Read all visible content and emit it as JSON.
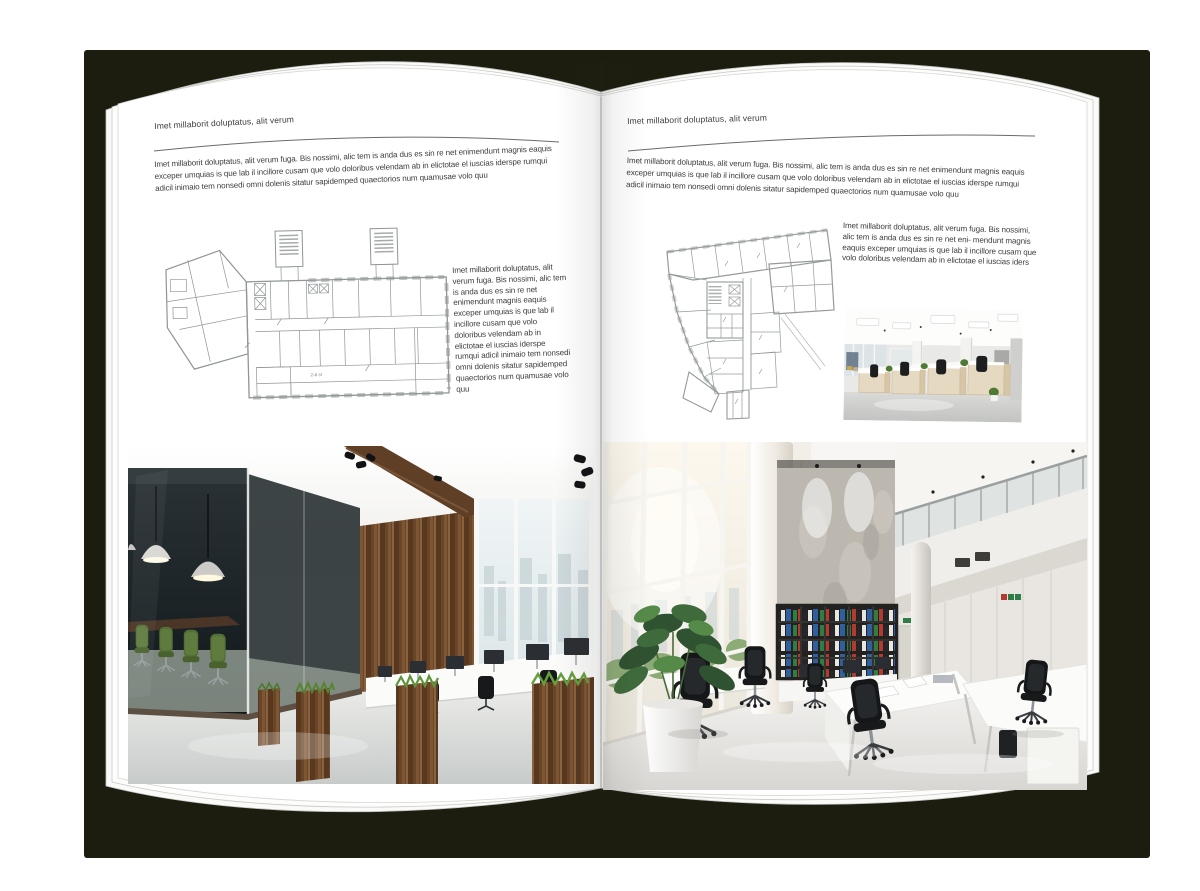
{
  "book": {
    "left_page": {
      "header": "Imet millaborit doluptatus, alit verum",
      "intro": "Imet millaborit doluptatus, alit verum fuga. Bis nossimi, alic tem is anda dus es sin re net enimendunt magnis eaquis exceper umquias is que lab il incillore cusam que volo doloribus velendam ab in elictotae el iuscias iderspe rumqui adicil inimaio tem nonsedi omni dolenis sitatur sapidemped quaectorios num quamusae volo quu",
      "side_text": "Imet millaborit doluptatus, alit verum fuga. Bis nossimi, alic tem is anda dus es sin re net enimendunt magnis eaquis exceper umquias is que lab il incillore cusam que volo doloribus velendam ab in elictotae el iuscias iderspe rumqui adicil inimaio tem nonsedi omni dolenis sitatur sapidemped quaectorios num quamusae volo quu",
      "floorplan_label": "2-й эт"
    },
    "right_page": {
      "header": "Imet millaborit doluptatus, alit verum",
      "intro": "Imet millaborit doluptatus, alit verum fuga. Bis nossimi, alic tem is anda dus es sin re net enimendunt magnis eaquis exceper umquias is que lab il incillore cusam que volo doloribus velendam ab in elictotae el iuscias iderspe rumqui adicil inimaio tem nonsedi omni dolenis sitatur sapidemped quaectorios num quamusae volo quu",
      "side_text": "Imet millaborit doluptatus, alit verum fuga. Bis nossimi, alic tem is anda dus es sin re net eni- mendunt magnis eaquis exceper umquias is que lab il incillore cusam que volo doloribus velendam ab in elictotae el iuscias iders"
    }
  },
  "colors": {
    "backdrop_shadow": "#1c1d0e",
    "page": "#ffffff",
    "text": "#3c3c3c",
    "header_rule": "#6b6b6b",
    "plan_line": "#848a8a",
    "wood_brown": "#6b4527",
    "chair_green": "#546f36",
    "plant_green": "#3f6b3c",
    "binder_green": "#2f7d3f",
    "binder_red": "#b23a30",
    "binder_blue": "#2f5f9e",
    "concrete_gray": "#bcb8b0",
    "floor_light": "#d9dbd8",
    "sky_pale": "#e8eef0"
  }
}
